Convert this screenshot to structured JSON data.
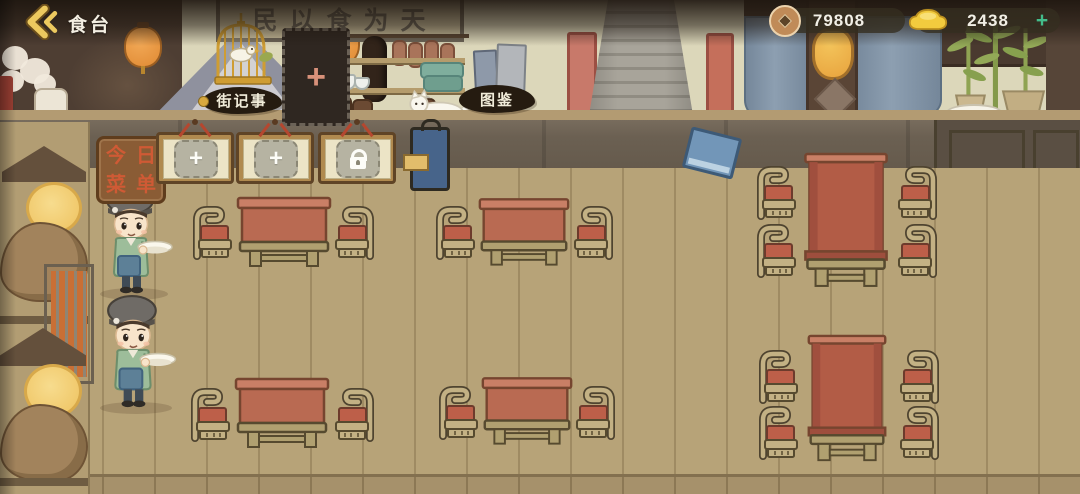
{
  "header": {
    "title": "食台"
  },
  "currencies": [
    {
      "name": "copper-coins",
      "value": "79808"
    },
    {
      "name": "gold-ingots",
      "value": "2438",
      "add": "+"
    }
  ],
  "signs": {
    "plaque": "民以食为天",
    "street_journal": "街记事",
    "catalog": "图鉴",
    "menu_board": {
      "chars": [
        "今",
        "日",
        "菜",
        "单"
      ]
    }
  },
  "menu_slots": [
    {
      "type": "add",
      "label": "+"
    },
    {
      "type": "add",
      "label": "+"
    },
    {
      "type": "locked"
    }
  ],
  "board_slot": {
    "label": "+"
  },
  "colors": {
    "accent_gold": "#e9c966",
    "add_green": "#43bd8b",
    "currency_pill_bg": "#342e20",
    "ink_label_bg": "#251b10",
    "table_red": "#b96a52",
    "cushion_red": "#bd5f49",
    "wall_cream": "#dcd7ba",
    "floor_tan": "#b7a378",
    "menu_sign_brown": "#8a5c35",
    "menu_sign_text": "#cf5a35",
    "slot_button_grey": "#b6b3a2"
  }
}
